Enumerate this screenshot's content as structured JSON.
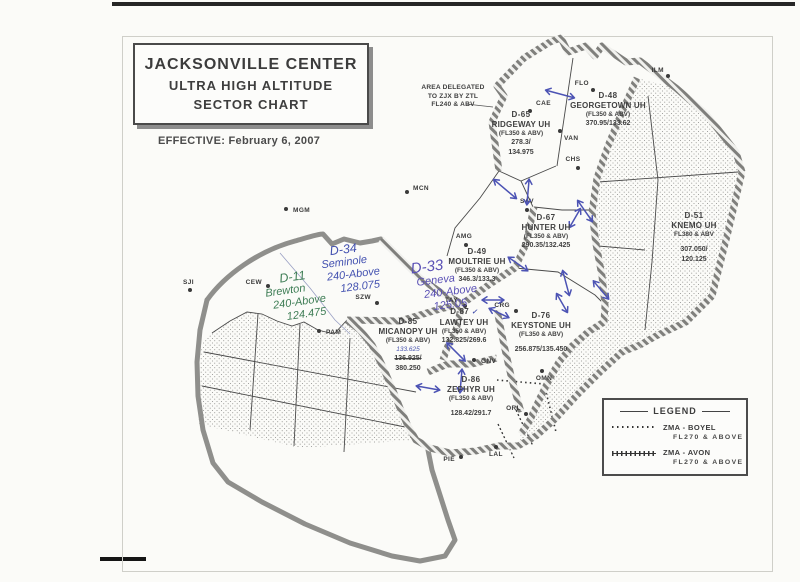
{
  "header": {
    "title_line1": "JACKSONVILLE CENTER",
    "title_line2": "ULTRA HIGH ALTITUDE",
    "title_line3": "SECTOR CHART",
    "effective": "EFFECTIVE:  February 6, 2007"
  },
  "map": {
    "delegated_note": [
      "AREA DELEGATED",
      "TO ZJX BY ZTL",
      "FL240 & ABV"
    ],
    "sectors": [
      {
        "id": "D-65",
        "name": "RIDGEWAY UH",
        "alt": "(FL350 & ABV)",
        "freq": [
          "278.3/",
          "134.975"
        ],
        "x": 521,
        "y": 110
      },
      {
        "id": "D-48",
        "name": "GEORGETOWN UH",
        "alt": "(FL350 & ABV)",
        "freq": [
          "370.95/133.62"
        ],
        "x": 608,
        "y": 91
      },
      {
        "id": "D-67",
        "name": "HUNTER UH",
        "alt": "(FL350 & ABV)",
        "freq": [
          "290.35/132.425"
        ],
        "x": 546,
        "y": 213
      },
      {
        "id": "D-51",
        "name": "KNEMO UH",
        "alt": "FL380 & ABV",
        "freq": [
          "307.050/",
          "120.125"
        ],
        "x": 694,
        "y": 211,
        "gap": true
      },
      {
        "id": "D-49",
        "name": "MOULTRIE UH",
        "alt": "(FL350 & ABV)",
        "freq": [
          "346.3/133.3"
        ],
        "x": 477,
        "y": 247
      },
      {
        "id": "D-87",
        "name": "LAWTEY UH",
        "alt": "(FL350 & ABV)",
        "freq": [
          "132.825/269.6"
        ],
        "x": 464,
        "y": 307,
        "hand_mark": "✓"
      },
      {
        "id": "D-76",
        "name": "KEYSTONE UH",
        "alt": "(FL350 & ABV)",
        "freq": [
          "256.875/135.450"
        ],
        "x": 541,
        "y": 311,
        "gap": true
      },
      {
        "id": "D-85",
        "name": "MICANOPY UH",
        "alt": "(FL350 & ABV)",
        "freq_hand": "133.625",
        "freq_struck": "136.925/",
        "freq": [
          "380.250"
        ],
        "x": 408,
        "y": 317
      },
      {
        "id": "D-86",
        "name": "ZEPHYR UH",
        "alt": "(FL350 & ABV)",
        "freq": [
          "128.42/291.7"
        ],
        "x": 471,
        "y": 375,
        "gap": true
      }
    ],
    "cities": [
      {
        "code": "MGM",
        "dx": 286,
        "dy": 209,
        "lx": 293,
        "ly": 212,
        "anchor": "start"
      },
      {
        "code": "MCN",
        "dx": 407,
        "dy": 192,
        "lx": 413,
        "ly": 190,
        "anchor": "start"
      },
      {
        "code": "CEW",
        "dx": 268,
        "dy": 286,
        "lx": 262,
        "ly": 284,
        "anchor": "end"
      },
      {
        "code": "SJI",
        "dx": 190,
        "dy": 290,
        "lx": 194,
        "ly": 284,
        "anchor": "end"
      },
      {
        "code": "PAM",
        "dx": 319,
        "dy": 331,
        "lx": 326,
        "ly": 334,
        "anchor": "start"
      },
      {
        "code": "SZW",
        "dx": 377,
        "dy": 303,
        "lx": 371,
        "ly": 299,
        "anchor": "end"
      },
      {
        "code": "TAY",
        "dx": 465,
        "dy": 306,
        "lx": 458,
        "ly": 302,
        "anchor": "end"
      },
      {
        "code": "AMG",
        "dx": 466,
        "dy": 245,
        "lx": 464,
        "ly": 238,
        "anchor": "middle"
      },
      {
        "code": "CRG",
        "dx": 516,
        "dy": 311,
        "lx": 510,
        "ly": 307,
        "anchor": "end"
      },
      {
        "code": "GNV",
        "dx": 474,
        "dy": 360,
        "lx": 481,
        "ly": 363,
        "anchor": "start"
      },
      {
        "code": "OMN",
        "dx": 542,
        "dy": 371,
        "lx": 544,
        "ly": 380,
        "anchor": "middle"
      },
      {
        "code": "ORL",
        "dx": 526,
        "dy": 414,
        "lx": 521,
        "ly": 410,
        "anchor": "end"
      },
      {
        "code": "PIE",
        "dx": 461,
        "dy": 457,
        "lx": 455,
        "ly": 461,
        "anchor": "end"
      },
      {
        "code": "LAL",
        "dx": 496,
        "dy": 447,
        "lx": 489,
        "ly": 456,
        "anchor": "start"
      },
      {
        "code": "SAV",
        "dx": 527,
        "dy": 210,
        "lx": 527,
        "ly": 203,
        "anchor": "middle"
      },
      {
        "code": "VAN",
        "dx": 560,
        "dy": 131,
        "lx": 564,
        "ly": 140,
        "anchor": "start"
      },
      {
        "code": "CHS",
        "dx": 578,
        "dy": 168,
        "lx": 573,
        "ly": 161,
        "anchor": "middle"
      },
      {
        "code": "CAE",
        "dx": 530,
        "dy": 111,
        "lx": 536,
        "ly": 105,
        "anchor": "start"
      },
      {
        "code": "FLO",
        "dx": 593,
        "dy": 90,
        "lx": 589,
        "ly": 85,
        "anchor": "end"
      },
      {
        "code": "ILM",
        "dx": 668,
        "dy": 76,
        "lx": 664,
        "ly": 72,
        "anchor": "end"
      }
    ],
    "handwritten": [
      {
        "name": "seminole-note",
        "x": 318,
        "y": 242,
        "rot": -7,
        "color": "#4351b0",
        "lines": [
          "D-34",
          "Seminole",
          "240-Above",
          "128.075"
        ],
        "indents": [
          14,
          4,
          8,
          20
        ],
        "big_first": false
      },
      {
        "name": "geneva-note",
        "x": 405,
        "y": 257,
        "rot": -7,
        "color": "#5a50b5",
        "lines": [
          "D-33",
          "Geneva",
          "240-Above",
          "125.05"
        ],
        "indents": [
          8,
          12,
          18,
          26
        ],
        "big_first": true
      },
      {
        "name": "brewton-note",
        "x": 260,
        "y": 270,
        "rot": -8,
        "color": "#3e7d55",
        "lines": [
          "D-11",
          "Brewton",
          "240-Above",
          "124.475"
        ],
        "indents": [
          22,
          6,
          12,
          24
        ],
        "big_first": false
      }
    ],
    "pen_arrows": [
      {
        "x": 560,
        "y": 94,
        "a": 15,
        "l": 30
      },
      {
        "x": 505,
        "y": 189,
        "a": 40,
        "l": 30
      },
      {
        "x": 528,
        "y": 192,
        "a": 95,
        "l": 26
      },
      {
        "x": 585,
        "y": 211,
        "a": 55,
        "l": 26
      },
      {
        "x": 575,
        "y": 218,
        "a": 120,
        "l": 22
      },
      {
        "x": 566,
        "y": 283,
        "a": 75,
        "l": 26
      },
      {
        "x": 518,
        "y": 264,
        "a": 35,
        "l": 24
      },
      {
        "x": 601,
        "y": 290,
        "a": 50,
        "l": 24
      },
      {
        "x": 493,
        "y": 300,
        "a": 0,
        "l": 22
      },
      {
        "x": 456,
        "y": 352,
        "a": 45,
        "l": 26
      },
      {
        "x": 499,
        "y": 313,
        "a": 25,
        "l": 22
      },
      {
        "x": 461,
        "y": 381,
        "a": 95,
        "l": 24
      },
      {
        "x": 428,
        "y": 388,
        "a": 10,
        "l": 24
      },
      {
        "x": 562,
        "y": 303,
        "a": 60,
        "l": 22
      }
    ],
    "pen_color": "#4c53b4"
  },
  "legend": {
    "title": "LEGEND",
    "items": [
      {
        "label": "ZMA - BOYEL",
        "sub": "FL270 & ABOVE",
        "style": "dotted"
      },
      {
        "label": "ZMA - AVON",
        "sub": "FL270 & ABOVE",
        "style": "crossed"
      }
    ]
  }
}
